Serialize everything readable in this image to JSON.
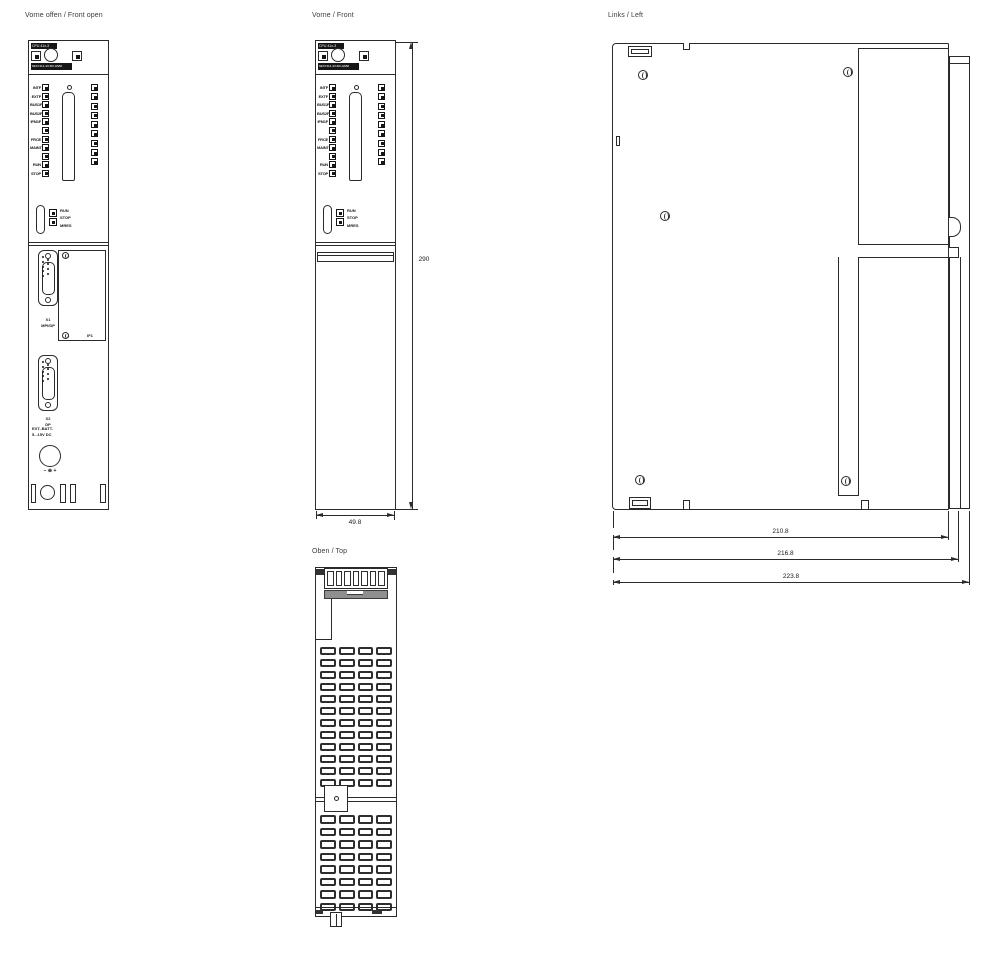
{
  "drawing": {
    "titles": {
      "front_open": "Vorne offen / Front open",
      "front": "Vorne / Front",
      "left": "Links / Left",
      "top": "Oben / Top"
    }
  },
  "faceplate": {
    "cpu_label": "CPU 41x-3",
    "order_number": "6ES7414-3XJ00-0AB0",
    "led_rows": [
      {
        "label": "INTF"
      },
      {
        "label": "EXTF"
      },
      {
        "label": "BUS1F"
      },
      {
        "label": "BUS2F"
      },
      {
        "label": "IFM1F"
      },
      {
        "label": ""
      },
      {
        "label": "FRCE"
      },
      {
        "label": "MAINT"
      },
      {
        "label": ""
      },
      {
        "label": "RUN"
      },
      {
        "label": "STOP"
      }
    ],
    "right_led_count": 9,
    "mode_switch_positions": [
      "RUN",
      "STOP",
      "MRES"
    ]
  },
  "connectors": {
    "x1_name": "X1",
    "x1_type": "MPI/DP",
    "if_slot": "IF1",
    "x2_name": "X2",
    "x2_type": "DP",
    "battery_label": "EXT.-BATT.",
    "battery_voltage": "5...15V DC",
    "battery_polarity": "− ⊕ +"
  },
  "dimensions_mm": {
    "height": "290",
    "width": "49.8",
    "depth_inner": "210.8",
    "depth_mid": "216.8",
    "depth_outer": "223.8"
  },
  "top_view": {
    "connector_slats": 7,
    "upper_vent_slots": 48,
    "lower_vent_slots": 32
  },
  "dsub": {
    "pins_left": 5,
    "pins_right": 4
  }
}
